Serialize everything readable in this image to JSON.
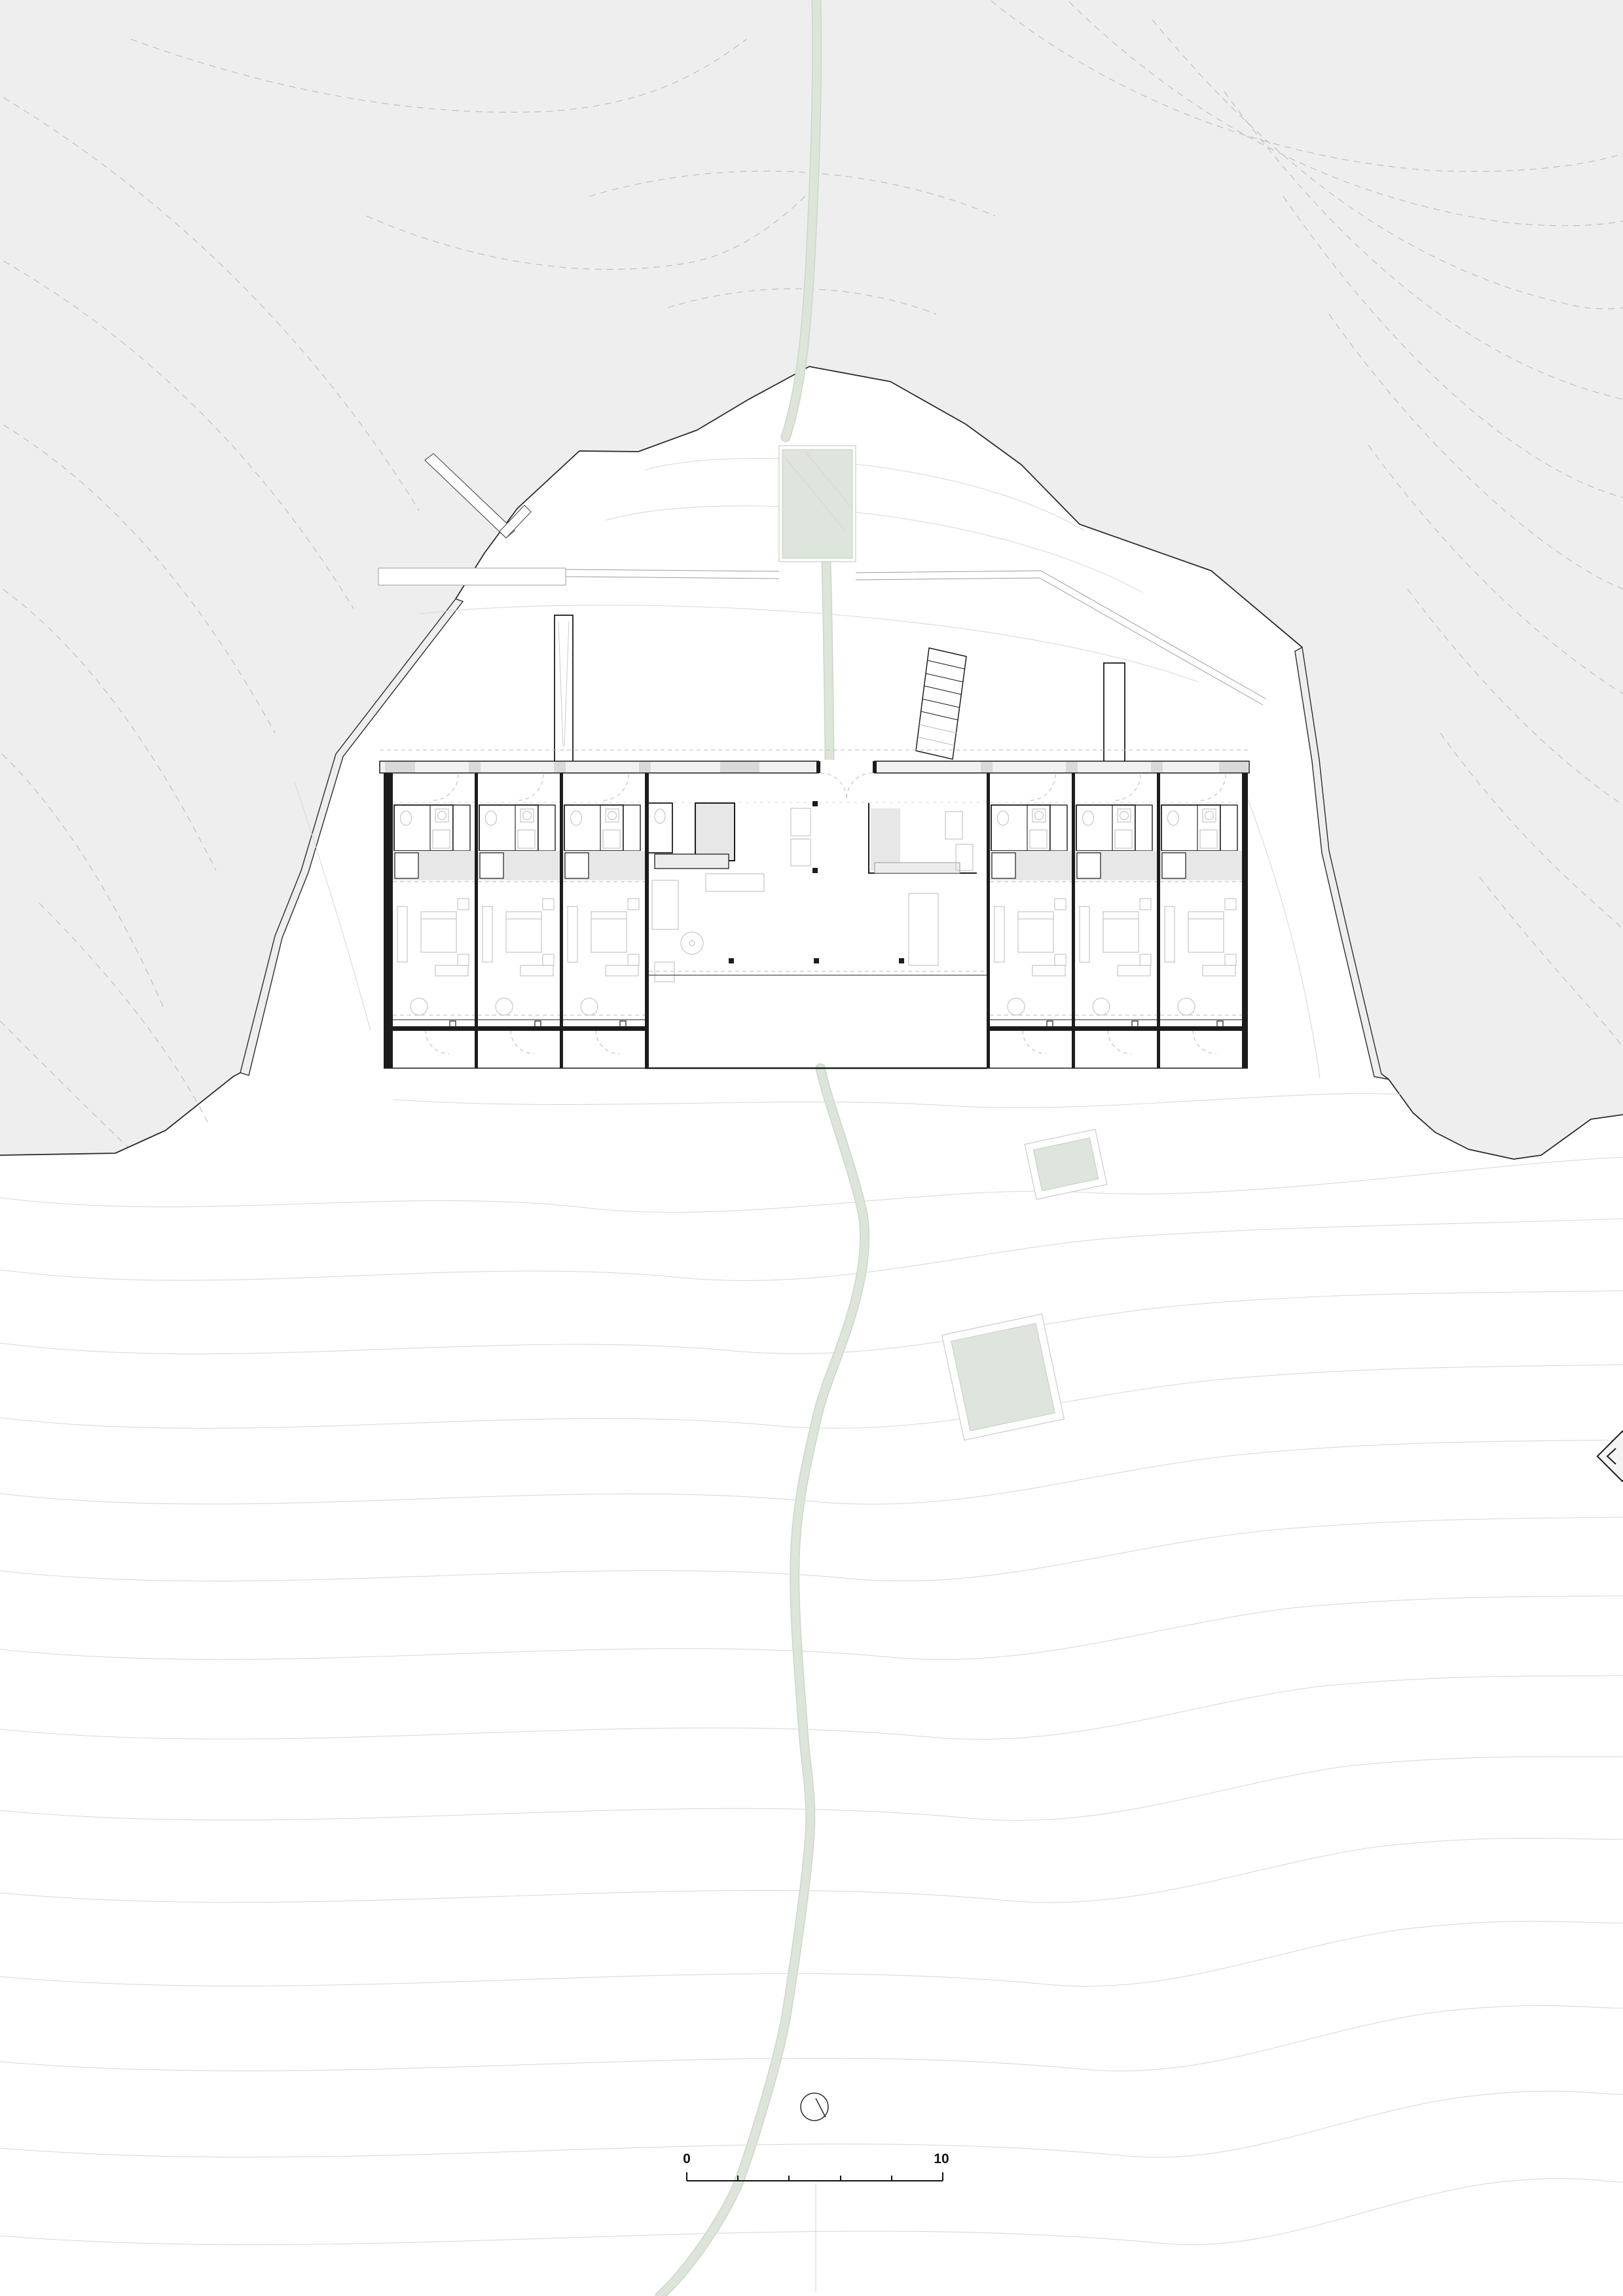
{
  "drawing": {
    "kind": "architectural site plan with ground floor plan",
    "visible_text_items": [
      "0",
      "10"
    ]
  },
  "scale_bar": {
    "start_label": "0",
    "end_label": "10",
    "divisions": 5
  },
  "plan": {
    "left_room_count": 3,
    "right_room_count": 3,
    "features": [
      "guest-room-modules",
      "central-lounge",
      "kitchen",
      "entry-doors",
      "terraces",
      "exterior-stair",
      "chimneys",
      "footpath",
      "upper-green-terrace",
      "two-green-garden-pads"
    ]
  },
  "icons": {
    "compass": "compass-icon",
    "section_marker": "section-marker-icon"
  },
  "colors": {
    "hill-fill": "#eeeeee",
    "hill-contour": "#bcbcbc",
    "site-contour": "#d9d9d9",
    "boundary": "#2b2b2b",
    "wall": "#1c1c1c",
    "furniture": "#c6c6c6",
    "floor-gray": "#e7e7e7",
    "green-fill": "#dee5dc",
    "path-green": "#dde5da",
    "path-edge": "#cbd8c9",
    "ink": "#111111"
  }
}
